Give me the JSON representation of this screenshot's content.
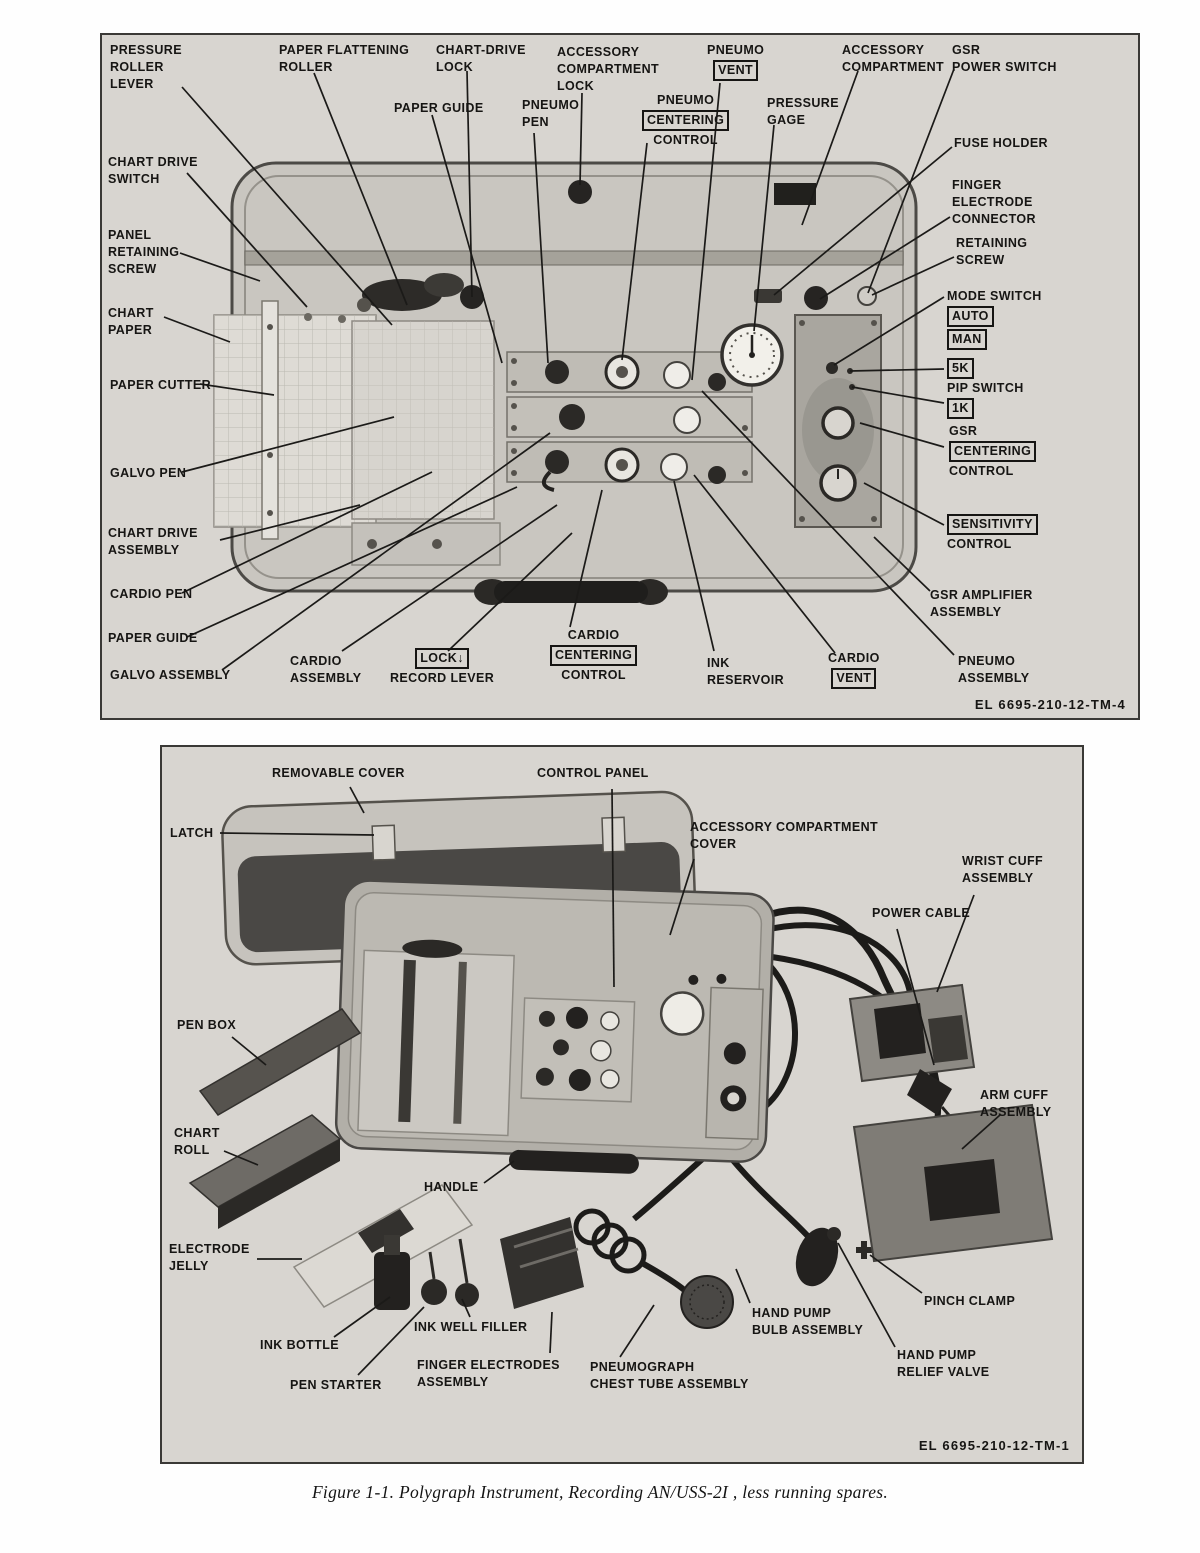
{
  "caption": "Figure 1-1.  Polygraph Instrument, Recording AN/USS-2I , less running spares.",
  "figure1": {
    "plate": "EL 6695-210-12-TM-4",
    "callouts": [
      {
        "id": "pressure-roller-lever",
        "x": 8,
        "y": 7,
        "lines": [
          {
            "t": "PRESSURE"
          },
          {
            "t": "ROLLER"
          },
          {
            "t": "LEVER"
          }
        ],
        "leaders": [
          [
            80,
            52,
            290,
            290
          ]
        ]
      },
      {
        "id": "chart-drive-switch",
        "x": 6,
        "y": 119,
        "lines": [
          {
            "t": "CHART DRIVE"
          },
          {
            "t": "SWITCH"
          }
        ],
        "leaders": [
          [
            85,
            138,
            205,
            272
          ]
        ]
      },
      {
        "id": "panel-retaining-screw",
        "x": 6,
        "y": 192,
        "lines": [
          {
            "t": "PANEL"
          },
          {
            "t": "RETAINING"
          },
          {
            "t": "SCREW"
          }
        ],
        "leaders": [
          [
            78,
            218,
            158,
            246
          ]
        ]
      },
      {
        "id": "chart-paper",
        "x": 6,
        "y": 270,
        "lines": [
          {
            "t": "CHART"
          },
          {
            "t": "PAPER"
          }
        ],
        "leaders": [
          [
            62,
            282,
            128,
            307
          ]
        ]
      },
      {
        "id": "paper-cutter",
        "x": 8,
        "y": 342,
        "lines": [
          {
            "t": "PAPER CUTTER"
          }
        ],
        "leaders": [
          [
            98,
            349,
            172,
            360
          ]
        ]
      },
      {
        "id": "galvo-pen",
        "x": 8,
        "y": 430,
        "lines": [
          {
            "t": "GALVO PEN"
          }
        ],
        "leaders": [
          [
            80,
            437,
            292,
            382
          ]
        ]
      },
      {
        "id": "chart-drive-assembly",
        "x": 6,
        "y": 490,
        "lines": [
          {
            "t": "CHART DRIVE"
          },
          {
            "t": "ASSEMBLY"
          }
        ],
        "leaders": [
          [
            118,
            505,
            258,
            470
          ]
        ]
      },
      {
        "id": "cardio-pen",
        "x": 8,
        "y": 551,
        "lines": [
          {
            "t": "CARDIO PEN"
          }
        ],
        "leaders": [
          [
            80,
            558,
            330,
            437
          ]
        ]
      },
      {
        "id": "paper-guide-left",
        "x": 6,
        "y": 595,
        "lines": [
          {
            "t": "PAPER GUIDE"
          }
        ],
        "leaders": [
          [
            85,
            602,
            415,
            452
          ]
        ]
      },
      {
        "id": "galvo-assembly",
        "x": 8,
        "y": 632,
        "lines": [
          {
            "t": "GALVO ASSEMBLY"
          }
        ],
        "leaders": [
          [
            120,
            635,
            448,
            398
          ]
        ]
      },
      {
        "id": "paper-flattening-roller",
        "x": 177,
        "y": 7,
        "lines": [
          {
            "t": "PAPER FLATTENING"
          },
          {
            "t": "ROLLER"
          }
        ],
        "leaders": [
          [
            212,
            38,
            305,
            270
          ]
        ]
      },
      {
        "id": "paper-guide-top",
        "x": 292,
        "y": 65,
        "lines": [
          {
            "t": "PAPER GUIDE"
          }
        ],
        "leaders": [
          [
            330,
            80,
            400,
            328
          ]
        ]
      },
      {
        "id": "chart-drive-lock",
        "x": 334,
        "y": 7,
        "lines": [
          {
            "t": "CHART-DRIVE"
          },
          {
            "t": "LOCK"
          }
        ],
        "leaders": [
          [
            365,
            36,
            370,
            262
          ]
        ]
      },
      {
        "id": "pneumo-pen",
        "x": 420,
        "y": 62,
        "lines": [
          {
            "t": "PNEUMO"
          },
          {
            "t": "PEN"
          }
        ],
        "leaders": [
          [
            432,
            98,
            446,
            328
          ]
        ]
      },
      {
        "id": "accessory-compartment-lock",
        "x": 455,
        "y": 9,
        "lines": [
          {
            "t": "ACCESSORY"
          },
          {
            "t": "COMPARTMENT"
          },
          {
            "t": "LOCK"
          }
        ],
        "leaders": [
          [
            480,
            58,
            478,
            150
          ]
        ]
      },
      {
        "id": "pneumo-centering-control",
        "x": 540,
        "y": 57,
        "center": true,
        "lines": [
          {
            "t": "PNEUMO"
          },
          {
            "t": "CENTERING",
            "box": true
          },
          {
            "t": "CONTROL"
          }
        ],
        "leaders": [
          [
            545,
            108,
            520,
            325
          ]
        ]
      },
      {
        "id": "pneumo-vent",
        "x": 605,
        "y": 7,
        "center": true,
        "lines": [
          {
            "t": "PNEUMO"
          },
          {
            "t": "VENT",
            "box": true
          }
        ],
        "leaders": [
          [
            618,
            48,
            590,
            345
          ]
        ]
      },
      {
        "id": "pressure-gage",
        "x": 665,
        "y": 60,
        "lines": [
          {
            "t": "PRESSURE"
          },
          {
            "t": "GAGE"
          }
        ],
        "leaders": [
          [
            672,
            90,
            652,
            296
          ]
        ]
      },
      {
        "id": "accessory-compartment",
        "x": 740,
        "y": 7,
        "lines": [
          {
            "t": "ACCESSORY"
          },
          {
            "t": "COMPARTMENT"
          }
        ],
        "leaders": [
          [
            756,
            36,
            700,
            190
          ]
        ]
      },
      {
        "id": "gsr-power-switch",
        "x": 850,
        "y": 7,
        "lines": [
          {
            "t": "GSR"
          },
          {
            "t": "POWER SWITCH"
          }
        ],
        "leaders": [
          [
            852,
            34,
            766,
            258
          ]
        ]
      },
      {
        "id": "fuse-holder",
        "x": 852,
        "y": 100,
        "lines": [
          {
            "t": "FUSE HOLDER"
          }
        ],
        "leaders": [
          [
            850,
            112,
            672,
            260
          ]
        ]
      },
      {
        "id": "finger-electrode-connector",
        "x": 850,
        "y": 142,
        "lines": [
          {
            "t": "FINGER"
          },
          {
            "t": "ELECTRODE"
          },
          {
            "t": "CONNECTOR"
          }
        ],
        "leaders": [
          [
            848,
            182,
            718,
            264
          ]
        ]
      },
      {
        "id": "retaining-screw",
        "x": 854,
        "y": 200,
        "lines": [
          {
            "t": "RETAINING"
          },
          {
            "t": "SCREW"
          }
        ],
        "leaders": [
          [
            852,
            222,
            770,
            260
          ]
        ]
      },
      {
        "id": "mode-switch",
        "x": 845,
        "y": 253,
        "lines": [
          {
            "t": "MODE SWITCH"
          },
          {
            "t": "AUTO",
            "box": true
          },
          {
            "t": "MAN",
            "box": true
          }
        ],
        "leaders": [
          [
            842,
            262,
            732,
            330
          ]
        ]
      },
      {
        "id": "pip-switch",
        "x": 845,
        "y": 322,
        "lines": [
          {
            "t": "5K",
            "box": true
          },
          {
            "t": "PIP SWITCH"
          },
          {
            "t": "1K",
            "box": true
          }
        ],
        "leaders": [
          [
            842,
            334,
            748,
            336
          ],
          [
            842,
            368,
            750,
            352
          ]
        ]
      },
      {
        "id": "gsr-centering-control",
        "x": 847,
        "y": 388,
        "lines": [
          {
            "t": "GSR"
          },
          {
            "t": "CENTERING",
            "box": true
          },
          {
            "t": "CONTROL"
          }
        ],
        "leaders": [
          [
            842,
            412,
            758,
            388
          ]
        ]
      },
      {
        "id": "sensitivity-control",
        "x": 845,
        "y": 478,
        "lines": [
          {
            "t": "SENSITIVITY",
            "box": true
          },
          {
            "t": "CONTROL"
          }
        ],
        "leaders": [
          [
            842,
            490,
            762,
            448
          ]
        ]
      },
      {
        "id": "gsr-amplifier-assembly",
        "x": 828,
        "y": 552,
        "lines": [
          {
            "t": "GSR AMPLIFIER"
          },
          {
            "t": "ASSEMBLY"
          }
        ],
        "leaders": [
          [
            828,
            556,
            772,
            502
          ]
        ]
      },
      {
        "id": "pneumo-assembly",
        "x": 856,
        "y": 618,
        "lines": [
          {
            "t": "PNEUMO"
          },
          {
            "t": "ASSEMBLY"
          }
        ],
        "leaders": [
          [
            852,
            620,
            600,
            356
          ]
        ]
      },
      {
        "id": "cardio-vent",
        "x": 726,
        "y": 615,
        "center": true,
        "lines": [
          {
            "t": "CARDIO"
          },
          {
            "t": "VENT",
            "box": true
          }
        ],
        "leaders": [
          [
            733,
            618,
            592,
            440
          ]
        ]
      },
      {
        "id": "ink-reservoir",
        "x": 605,
        "y": 620,
        "lines": [
          {
            "t": "INK"
          },
          {
            "t": "RESERVOIR"
          }
        ],
        "leaders": [
          [
            612,
            616,
            572,
            446
          ]
        ]
      },
      {
        "id": "cardio-centering-control",
        "x": 448,
        "y": 592,
        "center": true,
        "lines": [
          {
            "t": "CARDIO"
          },
          {
            "t": "CENTERING",
            "box": true
          },
          {
            "t": "CONTROL"
          }
        ],
        "leaders": [
          [
            468,
            592,
            500,
            455
          ]
        ]
      },
      {
        "id": "lock-record-lever",
        "x": 288,
        "y": 612,
        "center": true,
        "lines": [
          {
            "t": "LOCK↓",
            "box": true
          },
          {
            "t": "RECORD LEVER"
          }
        ],
        "leaders": [
          [
            346,
            616,
            470,
            498
          ]
        ]
      },
      {
        "id": "cardio-assembly",
        "x": 188,
        "y": 618,
        "lines": [
          {
            "t": "CARDIO"
          },
          {
            "t": "ASSEMBLY"
          }
        ],
        "leaders": [
          [
            240,
            616,
            455,
            470
          ]
        ]
      }
    ]
  },
  "figure2": {
    "plate": "EL 6695-210-12-TM-1",
    "callouts": [
      {
        "id": "removable-cover",
        "x": 110,
        "y": 18,
        "lines": [
          {
            "t": "REMOVABLE COVER"
          }
        ],
        "leaders": [
          [
            188,
            40,
            202,
            66
          ]
        ]
      },
      {
        "id": "control-panel",
        "x": 375,
        "y": 18,
        "lines": [
          {
            "t": "CONTROL PANEL"
          }
        ],
        "leaders": [
          [
            450,
            42,
            452,
            240
          ]
        ]
      },
      {
        "id": "latch",
        "x": 8,
        "y": 78,
        "lines": [
          {
            "t": "LATCH"
          }
        ],
        "leaders": [
          [
            58,
            86,
            212,
            88
          ]
        ]
      },
      {
        "id": "accessory-compartment-cover",
        "x": 528,
        "y": 72,
        "lines": [
          {
            "t": "ACCESSORY COMPARTMENT"
          },
          {
            "t": "COVER"
          }
        ],
        "leaders": [
          [
            532,
            112,
            508,
            188
          ]
        ]
      },
      {
        "id": "wrist-cuff-assembly",
        "x": 800,
        "y": 106,
        "lines": [
          {
            "t": "WRIST CUFF"
          },
          {
            "t": "ASSEMBLY"
          }
        ],
        "leaders": [
          [
            812,
            148,
            775,
            245
          ]
        ]
      },
      {
        "id": "power-cable",
        "x": 710,
        "y": 158,
        "lines": [
          {
            "t": "POWER CABLE"
          }
        ],
        "leaders": [
          [
            735,
            182,
            772,
            318
          ]
        ]
      },
      {
        "id": "pen-box",
        "x": 15,
        "y": 270,
        "lines": [
          {
            "t": "PEN BOX"
          }
        ],
        "leaders": [
          [
            70,
            290,
            104,
            318
          ]
        ]
      },
      {
        "id": "arm-cuff-assembly",
        "x": 818,
        "y": 340,
        "lines": [
          {
            "t": "ARM CUFF"
          },
          {
            "t": "ASSEMBLY"
          }
        ],
        "leaders": [
          [
            838,
            368,
            800,
            402
          ]
        ]
      },
      {
        "id": "chart-roll",
        "x": 12,
        "y": 378,
        "lines": [
          {
            "t": "CHART"
          },
          {
            "t": "ROLL"
          }
        ],
        "leaders": [
          [
            62,
            404,
            96,
            418
          ]
        ]
      },
      {
        "id": "handle",
        "x": 262,
        "y": 432,
        "lines": [
          {
            "t": "HANDLE"
          }
        ],
        "leaders": [
          [
            322,
            436,
            352,
            414
          ]
        ]
      },
      {
        "id": "electrode-jelly",
        "x": 7,
        "y": 494,
        "lines": [
          {
            "t": "ELECTRODE"
          },
          {
            "t": "JELLY"
          }
        ],
        "leaders": [
          [
            95,
            512,
            140,
            512
          ]
        ]
      },
      {
        "id": "ink-bottle",
        "x": 98,
        "y": 590,
        "lines": [
          {
            "t": "INK BOTTLE"
          }
        ],
        "leaders": [
          [
            172,
            590,
            228,
            550
          ]
        ]
      },
      {
        "id": "ink-well-filler",
        "x": 252,
        "y": 572,
        "lines": [
          {
            "t": "INK WELL FILLER"
          }
        ],
        "leaders": [
          [
            308,
            570,
            300,
            552
          ]
        ]
      },
      {
        "id": "pen-starter",
        "x": 128,
        "y": 630,
        "lines": [
          {
            "t": "PEN STARTER"
          }
        ],
        "leaders": [
          [
            196,
            628,
            262,
            560
          ]
        ]
      },
      {
        "id": "finger-electrodes-assembly",
        "x": 255,
        "y": 610,
        "lines": [
          {
            "t": "FINGER ELECTRODES"
          },
          {
            "t": "ASSEMBLY"
          }
        ],
        "leaders": [
          [
            388,
            606,
            390,
            565
          ]
        ]
      },
      {
        "id": "pneumograph-chest-tube-assembly",
        "x": 428,
        "y": 612,
        "lines": [
          {
            "t": "PNEUMOGRAPH"
          },
          {
            "t": "CHEST TUBE ASSEMBLY"
          }
        ],
        "leaders": [
          [
            458,
            610,
            492,
            558
          ]
        ]
      },
      {
        "id": "hand-pump-bulb-assembly",
        "x": 590,
        "y": 558,
        "lines": [
          {
            "t": "HAND PUMP"
          },
          {
            "t": "BULB ASSEMBLY"
          }
        ],
        "leaders": [
          [
            588,
            556,
            574,
            522
          ]
        ]
      },
      {
        "id": "pinch-clamp",
        "x": 762,
        "y": 546,
        "lines": [
          {
            "t": "PINCH CLAMP"
          }
        ],
        "leaders": [
          [
            760,
            546,
            708,
            508
          ]
        ]
      },
      {
        "id": "hand-pump-relief-valve",
        "x": 735,
        "y": 600,
        "lines": [
          {
            "t": "HAND PUMP"
          },
          {
            "t": "RELIEF VALVE"
          }
        ],
        "leaders": [
          [
            733,
            600,
            676,
            496
          ]
        ]
      }
    ]
  }
}
